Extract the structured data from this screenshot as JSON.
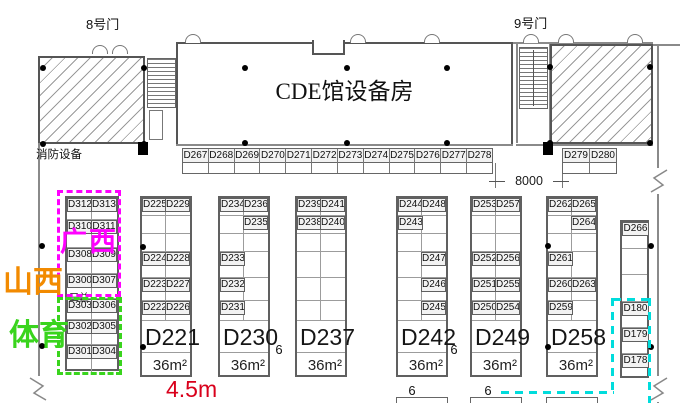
{
  "labels": {
    "gate8": "8号门",
    "gate9": "9号门",
    "equipment_room": "CDE馆设备房",
    "fire_equipment": "消防设备",
    "guangxi": "广西",
    "shanxi": "山西",
    "sports": "体育",
    "sanyi": "三益",
    "dim_width": "8000",
    "dim_depth": "4.5m"
  },
  "aisle_labels": [
    "6",
    "6",
    "6",
    "6"
  ],
  "top_strip": {
    "booths": [
      "D267",
      "D268",
      "D269",
      "D270",
      "D271",
      "D272",
      "D273",
      "D274",
      "D275",
      "D276",
      "D277",
      "D278"
    ]
  },
  "gate9_strip": {
    "booths": [
      "D279",
      "D280"
    ]
  },
  "blocks": [
    {
      "id": "block-d300",
      "big": "",
      "area": "",
      "note": "三益",
      "rows": [
        [
          "D312",
          "D313"
        ],
        [
          "D310",
          "D311"
        ],
        [
          "D308",
          "D309"
        ],
        [
          "D300",
          "D307"
        ],
        [
          "D303",
          "D306"
        ],
        [
          "D302",
          "D305"
        ],
        [
          "D301",
          "D304"
        ]
      ]
    },
    {
      "id": "block-d221",
      "big": "D221",
      "area": "36m²",
      "note": "",
      "rows": [
        [
          "D225",
          "D229"
        ],
        [
          "",
          ""
        ],
        [
          "",
          ""
        ],
        [
          "D224",
          "D228"
        ],
        [
          "D223",
          "D227"
        ],
        [
          "D222",
          "D226"
        ]
      ]
    },
    {
      "id": "block-d230",
      "big": "D230",
      "area": "36m²",
      "note": "",
      "rows": [
        [
          "D234",
          "D236"
        ],
        [
          "",
          "D235"
        ],
        [
          "",
          ""
        ],
        [
          "D233",
          ""
        ],
        [
          "D232",
          ""
        ],
        [
          "D231",
          ""
        ]
      ]
    },
    {
      "id": "block-d237",
      "big": "D237",
      "area": "36m²",
      "note": "",
      "rows": [
        [
          "D239",
          "D241"
        ],
        [
          "D238",
          "D240"
        ],
        [
          "",
          ""
        ],
        [
          "",
          ""
        ],
        [
          "",
          ""
        ],
        [
          "",
          ""
        ]
      ]
    },
    {
      "id": "block-d242",
      "big": "D242",
      "area": "36m²",
      "note": "",
      "rows": [
        [
          "D244",
          "D248"
        ],
        [
          "D243",
          ""
        ],
        [
          "",
          ""
        ],
        [
          "",
          "D247"
        ],
        [
          "",
          "D246"
        ],
        [
          "",
          "D245"
        ]
      ]
    },
    {
      "id": "block-d249",
      "big": "D249",
      "area": "36m²",
      "note": "",
      "rows": [
        [
          "D253",
          "D257"
        ],
        [
          "",
          ""
        ],
        [
          "",
          ""
        ],
        [
          "D252",
          "D256"
        ],
        [
          "D251",
          "D255"
        ],
        [
          "D250",
          "D254"
        ]
      ]
    },
    {
      "id": "block-d258",
      "big": "D258",
      "area": "36m²",
      "note": "",
      "rows": [
        [
          "D262",
          "D265"
        ],
        [
          "",
          "D264"
        ],
        [
          "",
          ""
        ],
        [
          "D261",
          ""
        ],
        [
          "D260",
          "D263"
        ],
        [
          "D259",
          ""
        ]
      ]
    }
  ],
  "right_column": {
    "booths": [
      "D266",
      "",
      "",
      "D180",
      "D179",
      "D178"
    ]
  },
  "colors": {
    "magenta": "#ff00ff",
    "orange": "#f28a00",
    "green": "#39d41d",
    "cyan": "#00dcdc",
    "red": "#d9001b"
  }
}
